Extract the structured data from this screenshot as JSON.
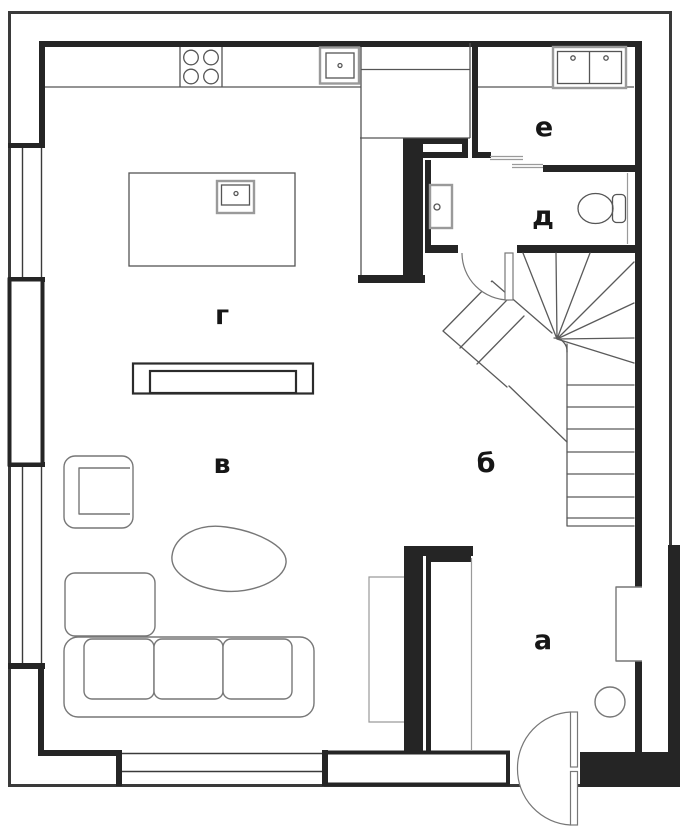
{
  "plan": {
    "type": "apartment-floor-plan",
    "rooms": [
      {
        "id": "g",
        "label": "г"
      },
      {
        "id": "v",
        "label": "в"
      },
      {
        "id": "b",
        "label": "б"
      },
      {
        "id": "a",
        "label": "а"
      },
      {
        "id": "d",
        "label": "д"
      },
      {
        "id": "e",
        "label": "е"
      }
    ],
    "colors": {
      "wall": "#252525",
      "label": "#161616",
      "outline": "#3a3a3a",
      "fixture": "#555555",
      "furniture": "#777777",
      "background": "#ffffff"
    }
  }
}
